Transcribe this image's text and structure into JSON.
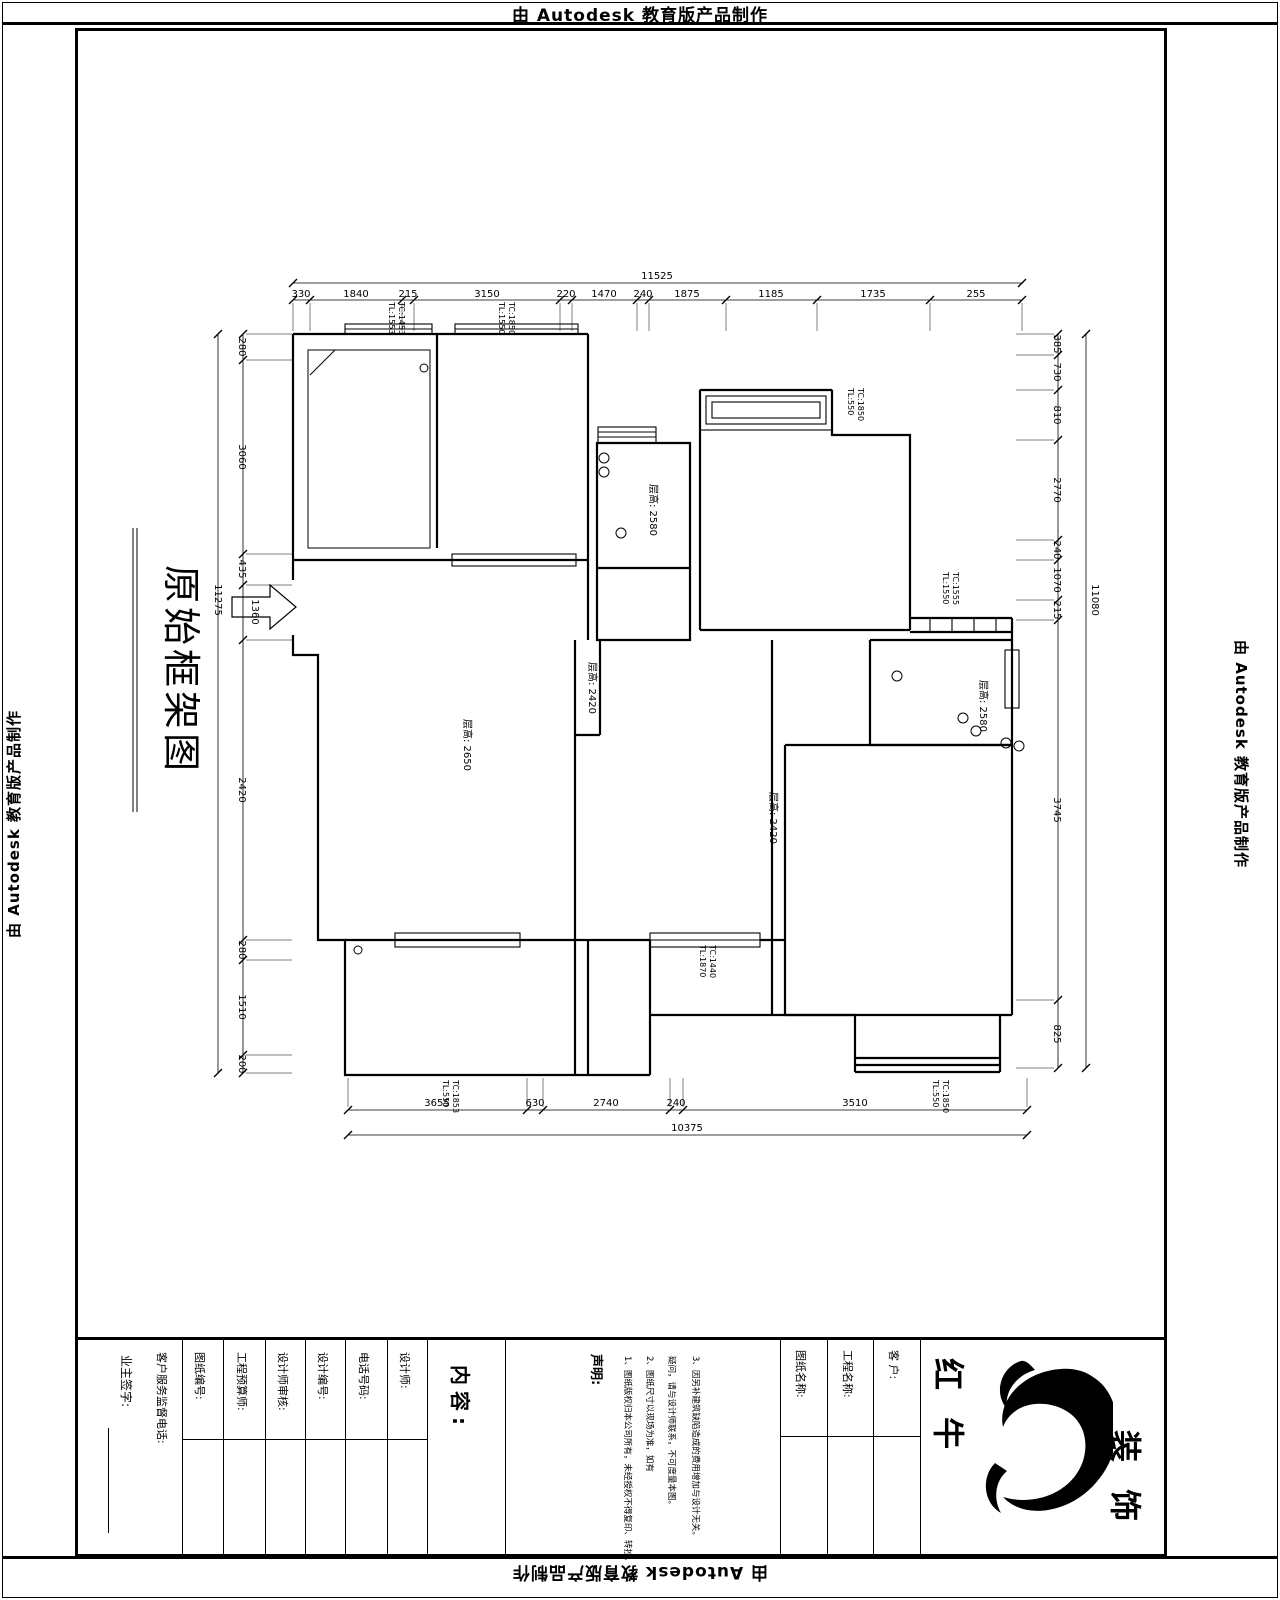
{
  "banners": {
    "top": "由 Autodesk 教育版产品制作",
    "bottom": "由 Autodesk 教育版产品制作",
    "left": "由 Autodesk 教育版产品制作",
    "right": "由 Autodesk 教育版产品制作"
  },
  "drawing": {
    "title": "原始框架图",
    "room_labels": [
      "层高: 2650",
      "层高: 2580",
      "层高: 2420",
      "层高: 2580",
      "层高: 2420"
    ],
    "window_tags": [
      [
        "TL:1553",
        "TC:1453"
      ],
      [
        "TL:1550",
        "TC:1850"
      ],
      [
        "TL:550",
        "TC:1850"
      ],
      [
        "TL:1550",
        "TC:1555"
      ],
      [
        "TL:1870",
        "TC:1440"
      ],
      [
        "TL:550",
        "TC:1853"
      ],
      [
        "TL:550",
        "TC:1850"
      ]
    ],
    "dims": {
      "top": {
        "total": "11525",
        "segments": [
          "330",
          "1840",
          "215",
          "3150",
          "220",
          "1470",
          "240",
          "1875",
          "1185",
          "1735",
          "255"
        ]
      },
      "left": {
        "total": "11275",
        "segments": [
          "280",
          "3060",
          "435",
          "1360",
          "2420",
          "280",
          "1510",
          "200"
        ]
      },
      "right": {
        "total": "11080",
        "segments": [
          "385",
          "730",
          "810",
          "2770",
          "240",
          "1070",
          "215",
          "3745",
          "825"
        ]
      },
      "bottom": {
        "total": "10375",
        "segments": [
          "3655",
          "630",
          "2740",
          "240",
          "3510"
        ]
      }
    }
  },
  "titleblock": {
    "owner_sign_label": "业主签字:",
    "service_label": "客户服务监督电话:",
    "fields": [
      "图纸编号:",
      "工程预算师:",
      "设计师审核:",
      "设计编号:",
      "电话号码:",
      "设计师:"
    ],
    "content_label": "内容:",
    "statement_label": "声明:",
    "statement_lines": [
      "1、图纸版权归本公司所有，未经授权不得复印、转抄。",
      "2、图纸尺寸以现场为准，如有",
      "疑问，请与设计师联系，不可度量本图。",
      "3、因另补建筑缺陷造成的费用增加与设计无关。"
    ],
    "name_fields": [
      "图纸名称:",
      "工程名称:",
      "客  户:"
    ],
    "brand": {
      "left": "红 牛",
      "right": "装 饰"
    }
  }
}
